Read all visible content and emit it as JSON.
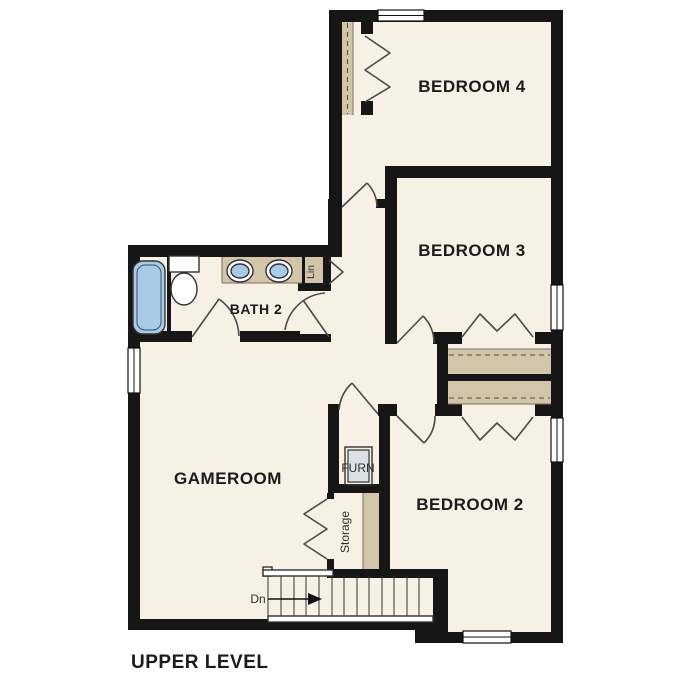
{
  "title": "UPPER LEVEL",
  "rooms": {
    "bedroom4": "BEDROOM 4",
    "bedroom3": "BEDROOM 3",
    "bedroom2": "BEDROOM 2",
    "gameroom": "GAMEROOM",
    "bath2": "BATH 2"
  },
  "closets": {
    "furnace": "FURN",
    "storage": "Storage",
    "linen": "Lin"
  },
  "stairs": {
    "direction_label": "Dn"
  },
  "colors": {
    "floor": "#f7f0e4",
    "wall": "#161616",
    "shelf_counter": "#d2c5a9",
    "water_fixture": "#a9cbe8",
    "furnace_unit": "#dce0e5",
    "background": "#ffffff"
  }
}
